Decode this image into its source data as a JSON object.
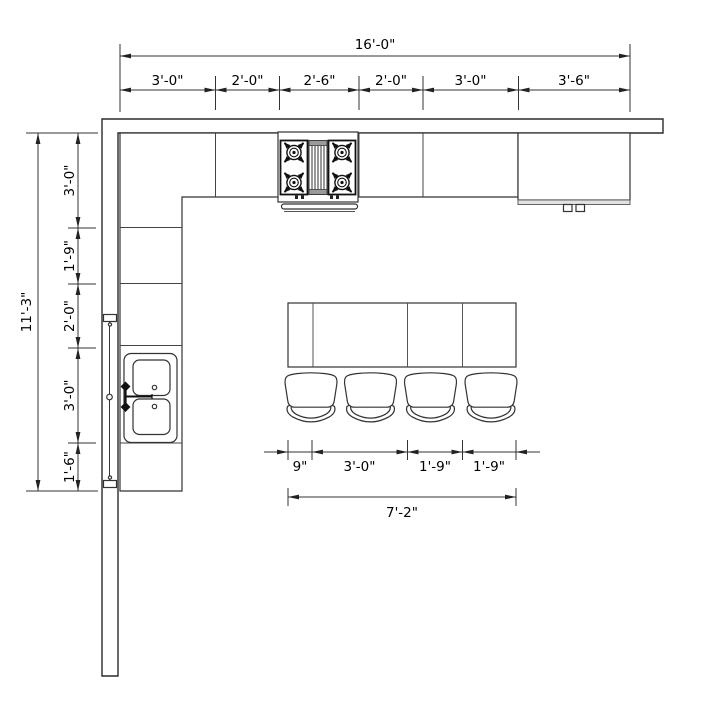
{
  "dimensions": {
    "top": {
      "total": "16'-0\"",
      "segments": [
        "3'-0\"",
        "2'-0\"",
        "2'-6\"",
        "2'-0\"",
        "3'-0\"",
        "3'-6\""
      ]
    },
    "left": {
      "total": "11'-3\"",
      "segments": [
        "3'-0\"",
        "1'-9\"",
        "2'-0\"",
        "3'-0\"",
        "1'-6\""
      ]
    },
    "island": {
      "total": "7'-2\"",
      "segments": [
        "9\"",
        "3'-0\"",
        "1'-9\"",
        "1'-9\""
      ]
    }
  },
  "fixtures": {
    "cooktop": "gas-cooktop-icon",
    "refrigerator": "refrigerator-icon",
    "sink": "double-bowl-sink-icon",
    "faucet": "faucet-icon",
    "window": "window-icon",
    "island": "kitchen-island",
    "stool": "bar-stool-icon"
  },
  "colors": {
    "line": "#333333",
    "wall": "#2b2b2b",
    "text": "#000000",
    "fill": "#ffffff",
    "appliance_band": "#e2e2e2"
  }
}
